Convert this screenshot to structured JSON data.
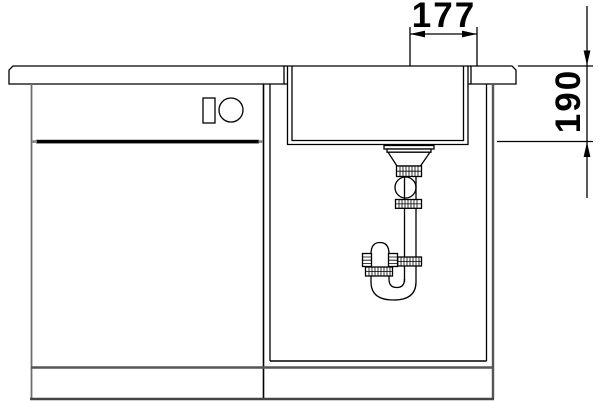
{
  "drawing": {
    "background_color": "#ffffff",
    "line_color": "#000000",
    "secondary_line_color": "#6e6e6e",
    "dimensions": {
      "top_width": {
        "label": "177"
      },
      "right_depth": {
        "label": "190"
      }
    }
  }
}
